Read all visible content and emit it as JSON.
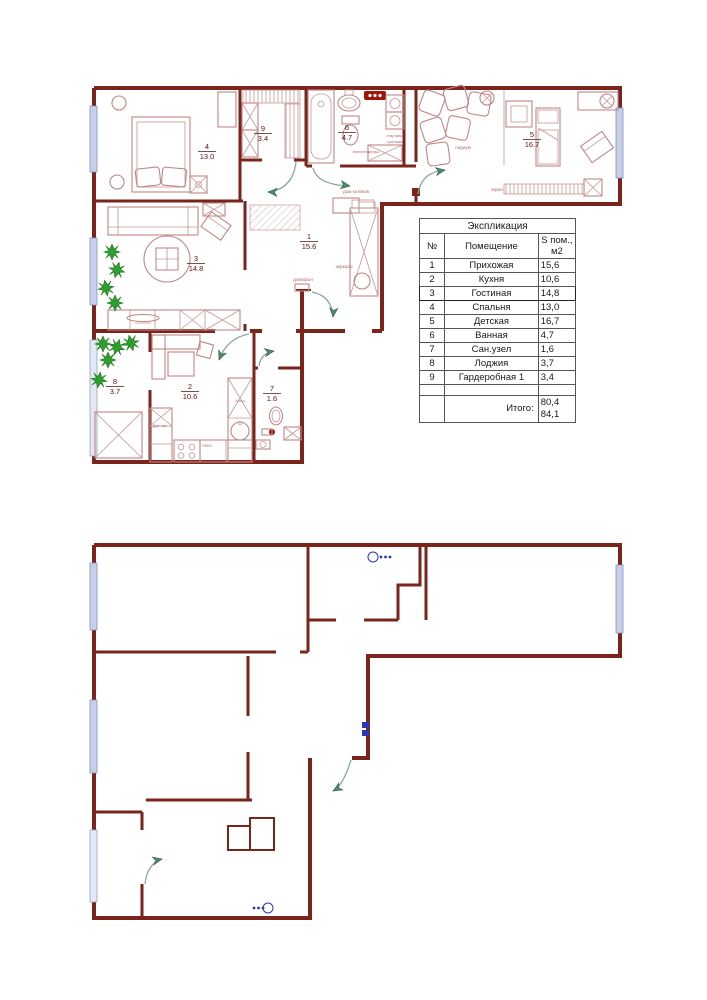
{
  "plan_furnished": {
    "rooms": [
      {
        "num": "1",
        "area": "15.6"
      },
      {
        "num": "2",
        "area": "10.6"
      },
      {
        "num": "3",
        "area": "14.8"
      },
      {
        "num": "4",
        "area": "13.0"
      },
      {
        "num": "5",
        "area": "16.7"
      },
      {
        "num": "6",
        "area": "4.7"
      },
      {
        "num": "7",
        "area": "1.6"
      },
      {
        "num": "8",
        "area": "3.7"
      },
      {
        "num": "9",
        "area": "3.4"
      }
    ],
    "annotations": {
      "mirror": "зеркало",
      "intercom": "домофон",
      "cat_house": "дом котиков",
      "podium": "подиум",
      "screen": "экран",
      "towel_dryer": "полотенцесуш.",
      "washer": "стир.маш",
      "dryer": "суш.маш",
      "fridge": "Хол-к",
      "oven": "Дух. шк.",
      "dishwasher": "ПММ"
    }
  },
  "legend": {
    "title": "Экспликация",
    "col_num": "№",
    "col_room": "Помещение",
    "col_area1": "S пом.,",
    "col_area2": "м2",
    "rows": [
      {
        "num": "1",
        "name": "Прихожая",
        "area": "15,6"
      },
      {
        "num": "2",
        "name": "Кухня",
        "area": "10,6"
      },
      {
        "num": "3",
        "name": "Гостиная",
        "area": "14,8"
      },
      {
        "num": "4",
        "name": "Спальня",
        "area": "13,0"
      },
      {
        "num": "5",
        "name": "Детская",
        "area": "16,7"
      },
      {
        "num": "6",
        "name": "Ванная",
        "area": "4,7"
      },
      {
        "num": "7",
        "name": "Сан.узел",
        "area": "1,6"
      },
      {
        "num": "8",
        "name": "Лоджия",
        "area": "3,7"
      },
      {
        "num": "9",
        "name": "Гардеробная 1",
        "area": "3,4"
      }
    ],
    "total_label": "Итого:",
    "totals": [
      "80,4",
      "84,1"
    ]
  },
  "colors": {
    "wall": "#7a241c",
    "furniture": "#c28585",
    "plant": "#2f9e2f",
    "door_arrow": "#4f8a6e",
    "window": "#c7d0e8",
    "plumbing_symbol": "#2b35c0",
    "fixture_dark": "#a31309"
  }
}
